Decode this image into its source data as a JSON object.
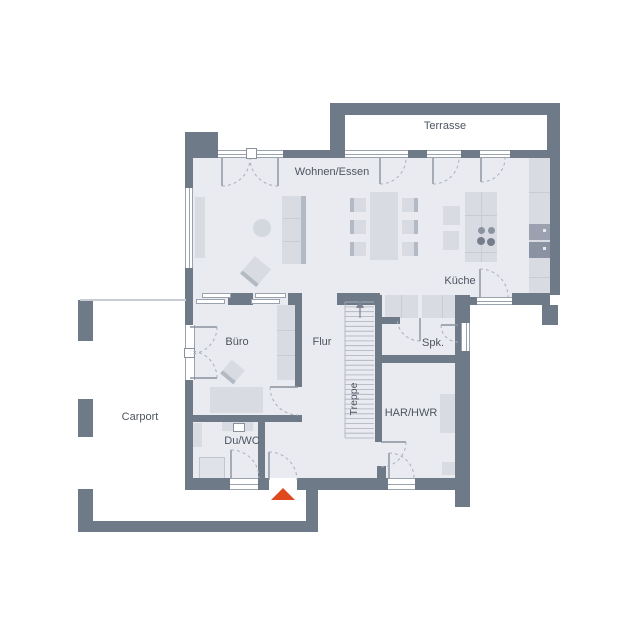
{
  "labels": {
    "terrasse": "Terrasse",
    "wohnen_essen": "Wohnen/Essen",
    "kueche": "Küche",
    "buero": "Büro",
    "flur": "Flur",
    "treppe": "Treppe",
    "spk": "Spk.",
    "har_hwr": "HAR/HWR",
    "du_wc": "Du/WC",
    "carport": "Carport"
  },
  "markers": {
    "entrance_marker": "entrance-arrow",
    "stair_direction": "up"
  },
  "palette": {
    "wall": "#6f7a89",
    "floor": "#e9ebf0",
    "furn": "#d8dbe1",
    "furnD": "#b4bac4",
    "line": "#c9cdd3",
    "winline": "#9aa2ae",
    "arc": "#a9afbb",
    "text": "#4e5461",
    "accent": "#e0481d"
  }
}
